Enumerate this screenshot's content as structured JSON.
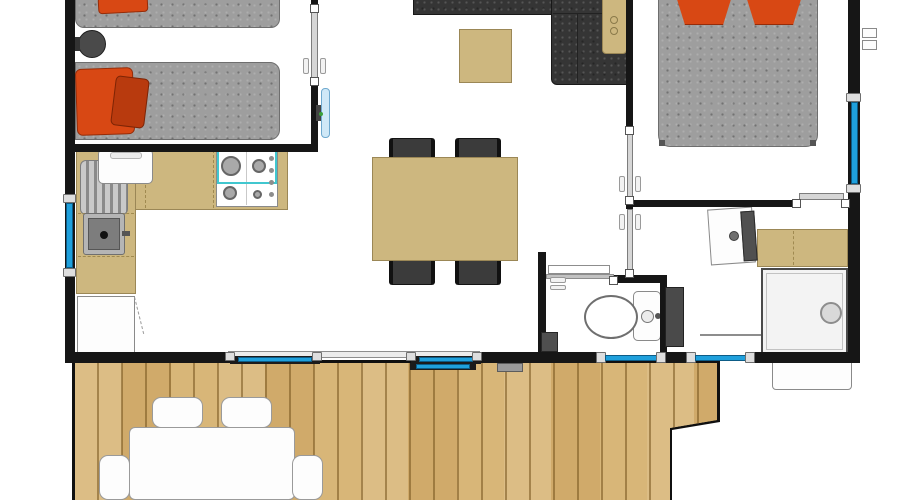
{
  "meta": {
    "type": "floor-plan",
    "description": "Top-down architectural floor plan of a mobile home with twin bedroom, open kitchen-living-dining area, master bedroom, shower room, WC and a wooden deck terrace. No text labels are rendered in the image."
  },
  "palette": {
    "wall": "#161616",
    "window_glass": "#1fa0dc",
    "window_frame": "#dedede",
    "door_leaf": "#d6d6d6",
    "counter": "#cdb77f",
    "counter_edge": "#9b8756",
    "sofa": "#353535",
    "chair": "#3b3b3b",
    "mattress": "#9e9e9e",
    "pillow": "#d84814",
    "pillow_shadow": "#b83a0e",
    "deck_wood": "#d6b577",
    "fixture_white": "#fdfdfd",
    "fixture_border": "#8a8a8a",
    "hob_accent": "#41c7cf",
    "tv_blue": "#cfe8f7",
    "shower_tray": "#f3f3f3",
    "appliance_dark": "#4a4a4a"
  },
  "rooms": [
    {
      "name": "bedroom-twin",
      "position": "top-left",
      "furniture": [
        "single-bed-1",
        "single-bed-2",
        "round-bedside-table",
        "red-pillow",
        "red-pillow-small"
      ]
    },
    {
      "name": "kitchen-living-dining",
      "position": "center",
      "furniture": [
        "l-shaped-kitchen-counter",
        "gas-hob-4-burners",
        "kitchen-sink",
        "dish-drainer",
        "counter-appliance",
        "under-counter-fridge",
        "corner-sofa",
        "sofa-side-table",
        "coffee-table",
        "dining-table",
        "dining-chair",
        "dining-chair",
        "dining-chair",
        "dining-chair",
        "wall-mounted-tv"
      ]
    },
    {
      "name": "bedroom-master",
      "position": "top-right",
      "furniture": [
        "double-bed",
        "red-pillow",
        "red-pillow"
      ]
    },
    {
      "name": "shower-room",
      "position": "right",
      "furniture": [
        "washbasin-with-vanity",
        "vanity-counter",
        "shower-cubicle"
      ]
    },
    {
      "name": "wc",
      "position": "bottom-center",
      "furniture": [
        "toilet",
        "waste-bin"
      ]
    },
    {
      "name": "hallway",
      "position": "center-right",
      "furniture": [
        "water-heater"
      ]
    },
    {
      "name": "deck-terrace",
      "position": "bottom",
      "furniture": [
        "outdoor-table",
        "outdoor-chair",
        "outdoor-chair",
        "outdoor-side-chair",
        "outdoor-side-chair",
        "door-mat"
      ]
    }
  ],
  "openings": {
    "windows": [
      "left-wall-window",
      "right-wall-window",
      "bottom-wall-window-1",
      "bottom-wall-window-2"
    ],
    "doors": [
      "patio-sliding-door",
      "twin-bedroom-door",
      "master-bedroom-door",
      "shower-room-door",
      "ensuite-door",
      "wc-sliding-door"
    ]
  }
}
